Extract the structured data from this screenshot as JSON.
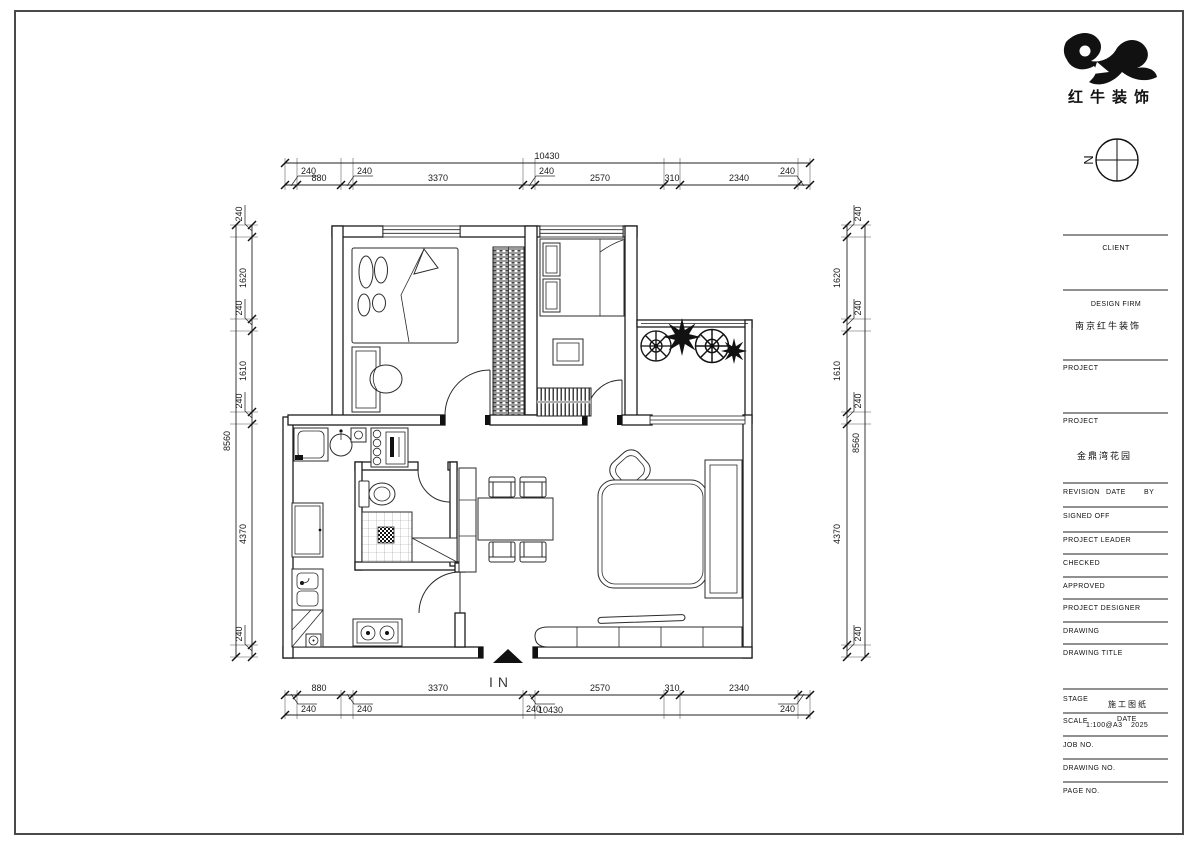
{
  "logo": {
    "company": "红牛装饰"
  },
  "north": {
    "label": "N"
  },
  "entrance": {
    "label": "IN"
  },
  "title_block": {
    "client_label": "CLIENT",
    "design_firm_label": "DESIGN FIRM",
    "design_firm_value": "南京红牛装饰",
    "project_label": "PROJECT",
    "project_value": "金鼎湾花园",
    "revision_label": "REVISION",
    "date_label": "DATE",
    "by_label": "BY",
    "signed_off_label": "SIGNED OFF",
    "project_leader_label": "PROJECT LEADER",
    "checked_label": "CHECKED",
    "approved_label": "APPROVED",
    "project_designer_label": "PROJECT DESIGNER",
    "drawing_label": "DRAWING",
    "drawing_title_label": "DRAWING TITLE",
    "stage_label": "STAGE",
    "stage_value": "施工图纸",
    "scale_label": "SCALE",
    "scale_value": "1:100@A3",
    "date2_label": "DATE",
    "date_value": "2025",
    "job_no_label": "JOB NO.",
    "drawing_no_label": "DRAWING NO.",
    "page_no_label": "PAGE NO."
  },
  "dims": {
    "top": {
      "total": "10430",
      "segments": [
        "880",
        "3370",
        "2570",
        "310",
        "2340"
      ],
      "small": [
        "240",
        "240",
        "240",
        "240"
      ]
    },
    "bottom": {
      "total": "10430",
      "segments": [
        "880",
        "3370",
        "2570",
        "310",
        "2340"
      ],
      "small": [
        "240",
        "240",
        "240",
        "240"
      ]
    },
    "left": {
      "total": "8560",
      "segments": [
        "1620",
        "1610",
        "4370"
      ],
      "small": [
        "240",
        "240",
        "240",
        "240"
      ]
    },
    "right": {
      "total": "8560",
      "segments": [
        "1620",
        "1610",
        "4370"
      ],
      "small": [
        "240",
        "240",
        "240",
        "240"
      ]
    }
  }
}
